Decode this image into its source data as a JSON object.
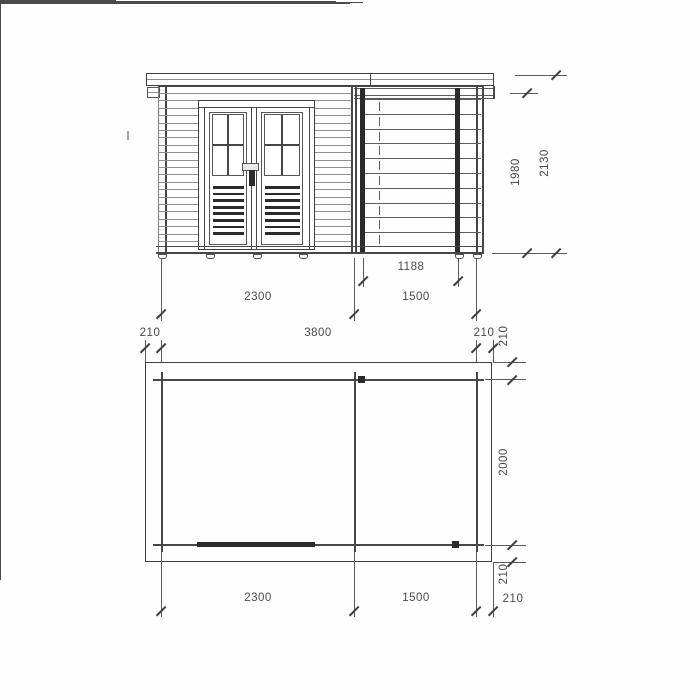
{
  "drawing_type": "garden-shed technical drawing, front elevation and floor plan",
  "elevation": {
    "dim_opening_width": "1188",
    "dim_section_left_width": "2300",
    "dim_section_right_width": "1500",
    "dim_wall_height": "1980",
    "dim_total_height": "2130"
  },
  "footprint": {
    "dim_overhang_left": "210",
    "dim_total_width": "3800",
    "dim_overhang_right": "210"
  },
  "plan": {
    "dim_overhang_top": "210",
    "dim_depth": "2000",
    "dim_overhang_bottom": "210",
    "dim_overhang_side": "210",
    "dim_section_left_width": "2300",
    "dim_section_right_width": "1500"
  }
}
